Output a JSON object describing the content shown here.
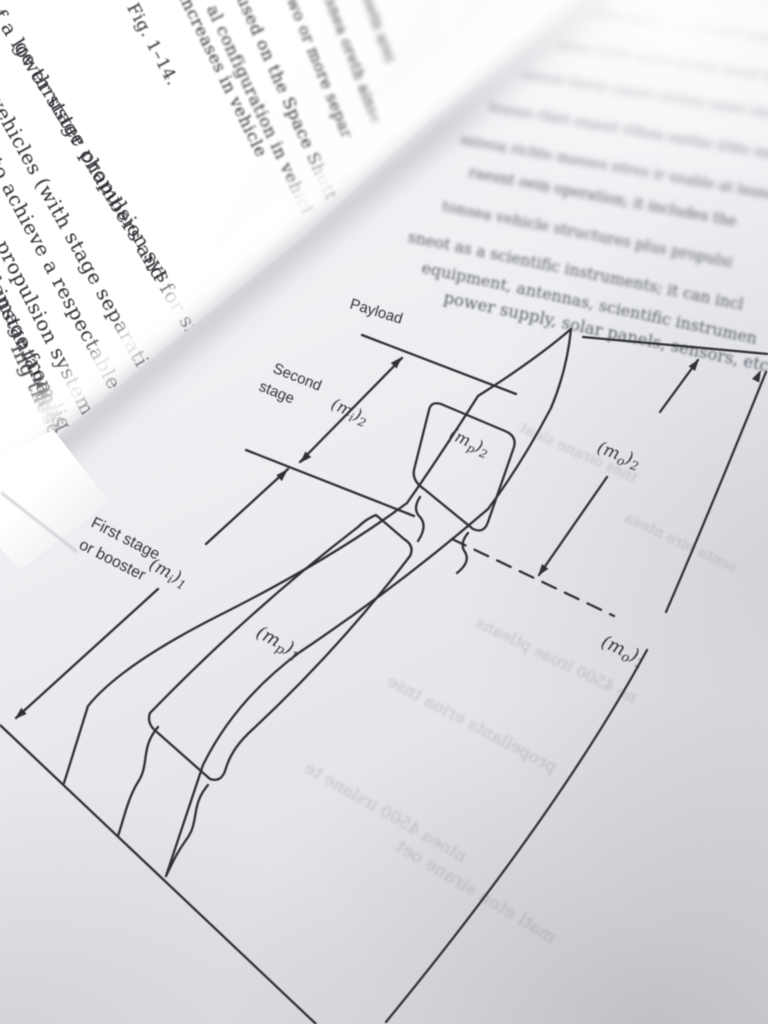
{
  "colors": {
    "paper": "#ecedf0",
    "ink": "#2f2f36",
    "faint_text": "#5d616c",
    "spine_highlight": "#ffffff"
  },
  "left_page": {
    "lines": [
      {
        "text": "of a lower stage propulsion sys"
      },
      {
        "text": "ge thruster chambers and for sma"
      },
      {
        "text": "vehicles (with stage separation syst"
      },
      {
        "text": ") to achieve a respectable s"
      },
      {
        "text": "age propulsion system fo"
      },
      {
        "text": "r damage from liqu"
      },
      {
        "text": "instantaneous"
      },
      {
        "text": "ing these"
      },
      {
        "text": "the"
      }
    ],
    "spine_lines": [
      {
        "text": "Fig. 1–14."
      },
      {
        "text": "increases in vehicle"
      },
      {
        "text": "al configuration in vehicl"
      },
      {
        "text": "used on the Space Shutt"
      },
      {
        "text": "two or more separ"
      },
      {
        "text": "tsnea oreth ainse"
      },
      {
        "text": "soetn arei"
      }
    ]
  },
  "right_page": {
    "paragraph_rows": [
      "tesn oaneth rseoit naeth soen itrea ntheso",
      "oanse terhn oaiest nretho asenit hreta osn ie",
      "nsoeat therin oanset eirthon asnet oirae nst oe",
      "teanso rhiet onaset rithen oastne irhte onsa et",
      "snteoa richte masses ntreo ir usable at launch",
      "raesnt oein operation; it includes the",
      "tonsea vehicle structures plus propulsi",
      "sneot as a scientific instruments; it can incl",
      "equipment, antennas, scientific instrumen",
      "power supply, solar panels, sensors, etc."
    ],
    "show_through_rows": [
      "tnes oirane sleat",
      "ne 4500 iroae ptleans",
      "propellants erioa tnse",
      "ntoea 4500 irslane te",
      "matl eton sirane oet",
      "senta oire ntesa"
    ],
    "figure": {
      "labels": {
        "payload": "Payload",
        "second_stage_l1": "Second",
        "second_stage_l2": "stage",
        "first_stage_l1": "First stage",
        "first_stage_l2": "or booster",
        "m_i_2": {
          "open": "(m",
          "sub": "i",
          "close": ")",
          "stage": "2"
        },
        "m_i_1": {
          "open": "(m",
          "sub": "i",
          "close": ")",
          "stage": "1"
        },
        "m_p_2": {
          "open": "(m",
          "sub": "p",
          "close": ")",
          "stage": "2"
        },
        "m_p_1": {
          "open": "(m",
          "sub": "p",
          "close": ")",
          "stage": "1"
        },
        "m_0_2": {
          "open": "(m",
          "sub": "o",
          "close": ")",
          "stage": "2"
        },
        "m_0_1": {
          "open": "(m",
          "sub": "o",
          "close": ")",
          "stage": "1"
        }
      }
    }
  }
}
